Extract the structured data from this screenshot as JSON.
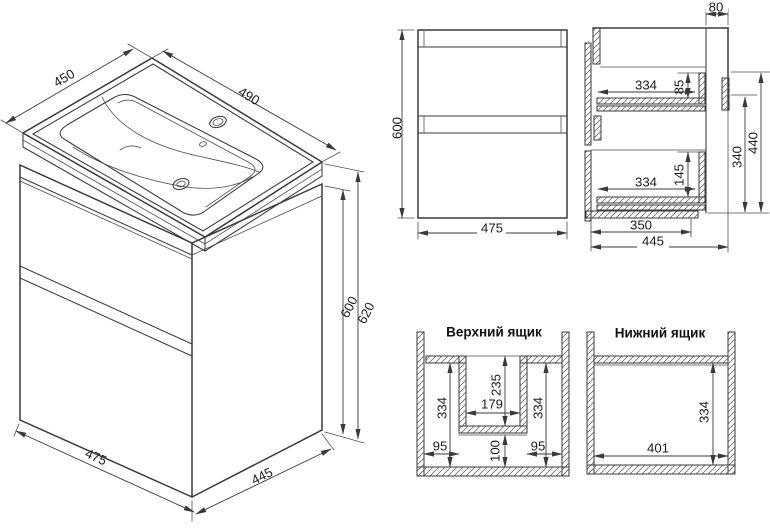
{
  "colors": {
    "background": "#ffffff",
    "line": "#3a3a3a",
    "text": "#1c1c1c"
  },
  "views": {
    "isometric": {
      "dims": {
        "sink_depth": "450",
        "sink_width": "490",
        "total_height": "620",
        "cabinet_height": "600",
        "cabinet_width": "475",
        "cabinet_depth": "445"
      }
    },
    "front": {
      "dims": {
        "height": "600",
        "width": "475"
      }
    },
    "side": {
      "dims": {
        "back_gap": "80",
        "upper_drawer_depth": "334",
        "upper_drawer_height": "85",
        "lower_drawer_depth": "334",
        "lower_drawer_height": "145",
        "body_depth": "350",
        "total_depth": "445",
        "inner_height": "340",
        "body_height": "440"
      }
    },
    "upper_drawer": {
      "title": "Верхний ящик",
      "dims": {
        "left_depth": "334",
        "left_width": "95",
        "cutout_depth": "235",
        "cutout_width": "179",
        "front_depth": "100",
        "right_depth": "334",
        "right_width": "95"
      }
    },
    "lower_drawer": {
      "title": "Нижний ящик",
      "dims": {
        "width": "401",
        "depth": "334"
      }
    }
  }
}
